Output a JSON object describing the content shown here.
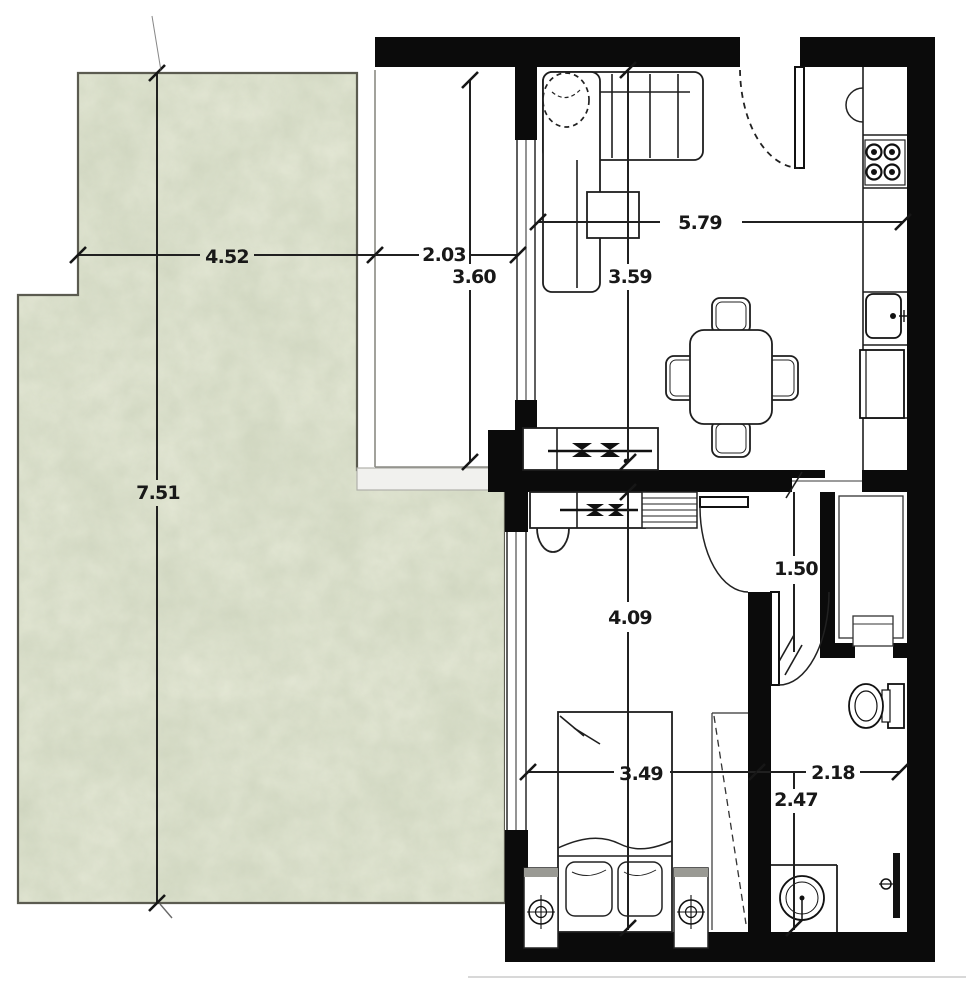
{
  "document": {
    "type": "apartment-floor-plan-scan",
    "units_shown": "decimal-length-labels"
  },
  "dims": {
    "terrace_width": "4.52",
    "terrace_depth": "7.51",
    "balcony_width": "2.03",
    "balcony_depth": "3.60",
    "living_width": "5.79",
    "living_depth": "3.59",
    "bedroom_depth": "4.09",
    "bedroom_width": "3.49",
    "hallway_depth": "1.50",
    "bathroom_width": "2.18",
    "bathroom_depth": "2.47"
  },
  "colors": {
    "wall": "#0b0b0b",
    "terrace_fill": "#d5dbc5",
    "terrace_border": "#5b5b50",
    "line": "#1e1e1e",
    "dim_text": "#181818",
    "parapet": "#f1f1ee",
    "background": "#ffffff"
  },
  "fixtures": [
    "corner-sofa",
    "plant",
    "coffee-table",
    "tv-console",
    "dining-table",
    "dining-chairs",
    "entrance-door",
    "kitchen-counter",
    "stove-burners",
    "kitchen-sink",
    "refrigerator",
    "desk-with-tv",
    "desk-chair",
    "shelf-unit",
    "bed",
    "pillows",
    "nightstand-lamps",
    "wardrobe-mirror",
    "closet",
    "toilet",
    "washbasin",
    "shower-door",
    "door-swing-arcs"
  ]
}
